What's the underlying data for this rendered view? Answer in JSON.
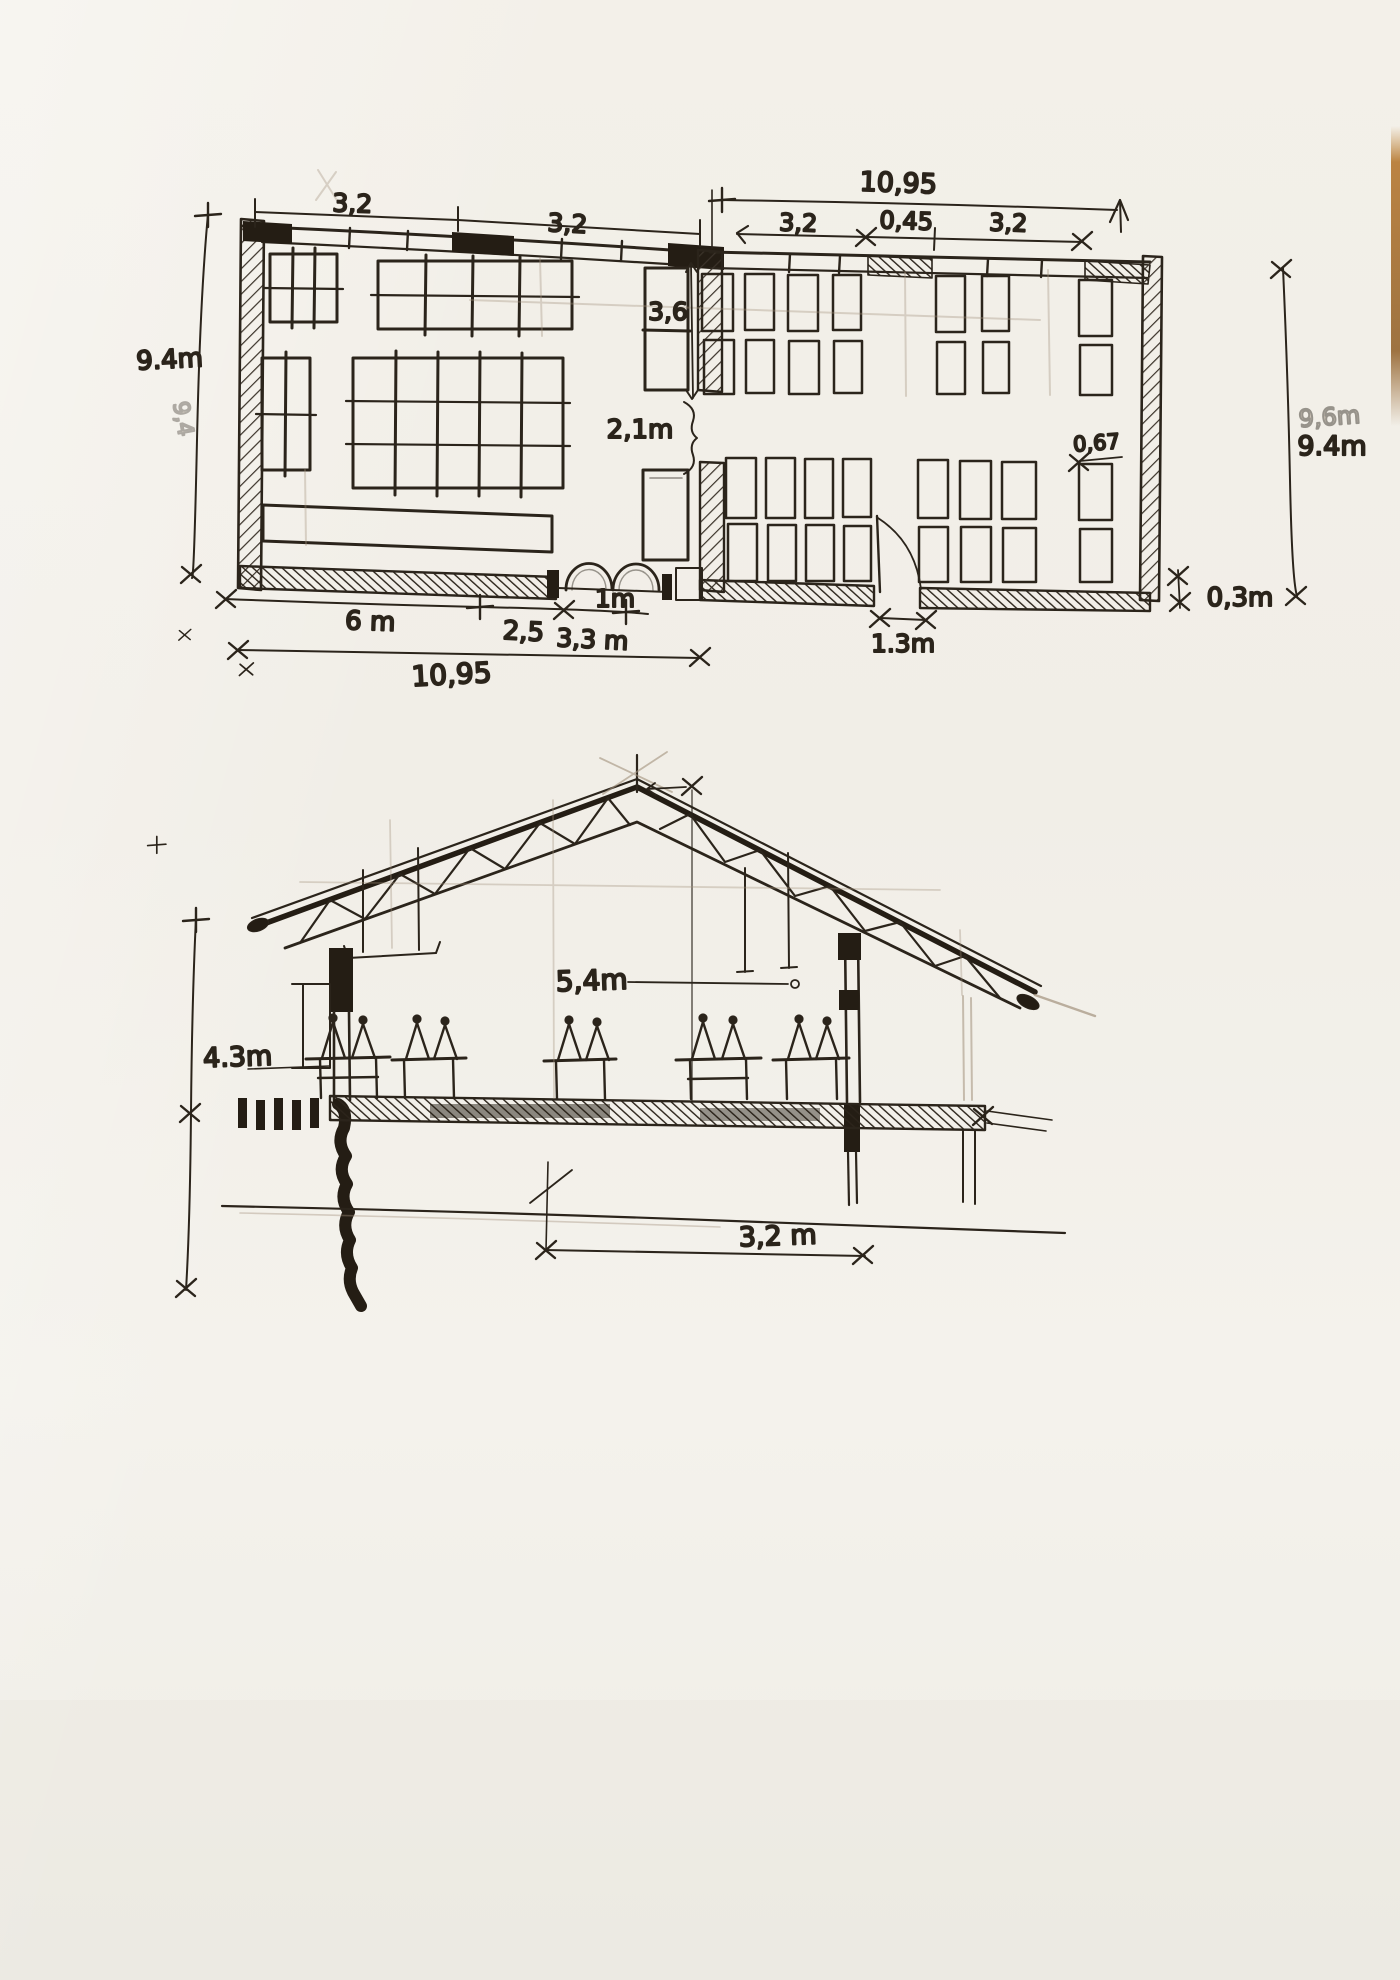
{
  "plan": {
    "dim_top_left_a": "3,2",
    "dim_top_left_b": "3,2",
    "dim_top_overall": "10,95",
    "dim_top_sub_a": "3,2",
    "dim_top_sub_b": "0,45",
    "dim_top_sub_c": "3,2",
    "dim_left_height": "9.4m",
    "dim_left_height_pencil": "9,4",
    "dim_right_height": "9.4m",
    "dim_right_height_pencil": "9,6m",
    "dim_mid_window": "3,6",
    "dim_mid_opening": "2,1m",
    "dim_desk": "0,67",
    "dim_bottom_a": "6 m",
    "dim_bottom_b": "2,5",
    "dim_bottom_c": "3,3 m",
    "dim_bottom_d": "1m",
    "dim_bottom_overall": "10,95",
    "dim_door": "1.3m",
    "dim_wall": "0,3m"
  },
  "section": {
    "dim_ridge": "5,4m",
    "dim_eave": "4.3m",
    "dim_bay": "3,2 m"
  },
  "colors": {
    "paper": "#f2efe8",
    "ink": "#2b241b",
    "heavy_ink": "#231c13",
    "pencil": "#a2917c",
    "page_edge": "#a96f2e"
  }
}
